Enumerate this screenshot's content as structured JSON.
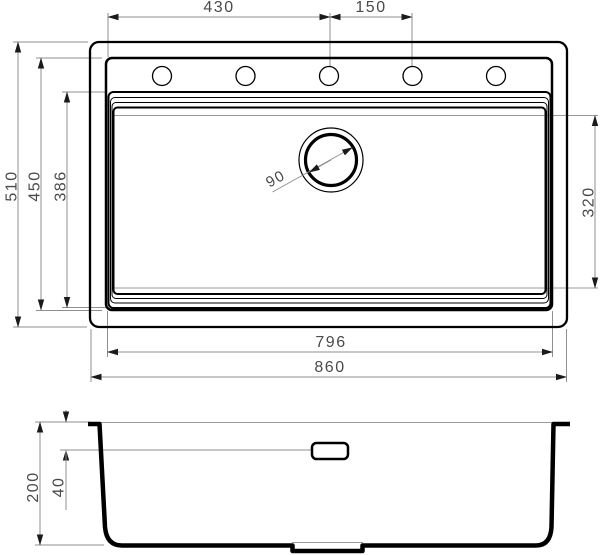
{
  "colors": {
    "object_line": "#000000",
    "dimension_line": "#8f8f8f",
    "label_text": "#4a4a4a",
    "background": "#ffffff"
  },
  "plan_view": {
    "dims": {
      "rim_edge_to_center_hole": "430",
      "faucet_hole_spacing": "150",
      "overall_depth": "510",
      "rim_opening_depth": "450",
      "bowl_depth": "386",
      "drain_diameter": "90",
      "bowl_floor_depth": "320",
      "rim_opening_width": "796",
      "overall_width": "860"
    },
    "faucet_hole_count": 5
  },
  "section_view": {
    "dims": {
      "total_depth": "200",
      "overflow_from_rim": "40"
    }
  }
}
